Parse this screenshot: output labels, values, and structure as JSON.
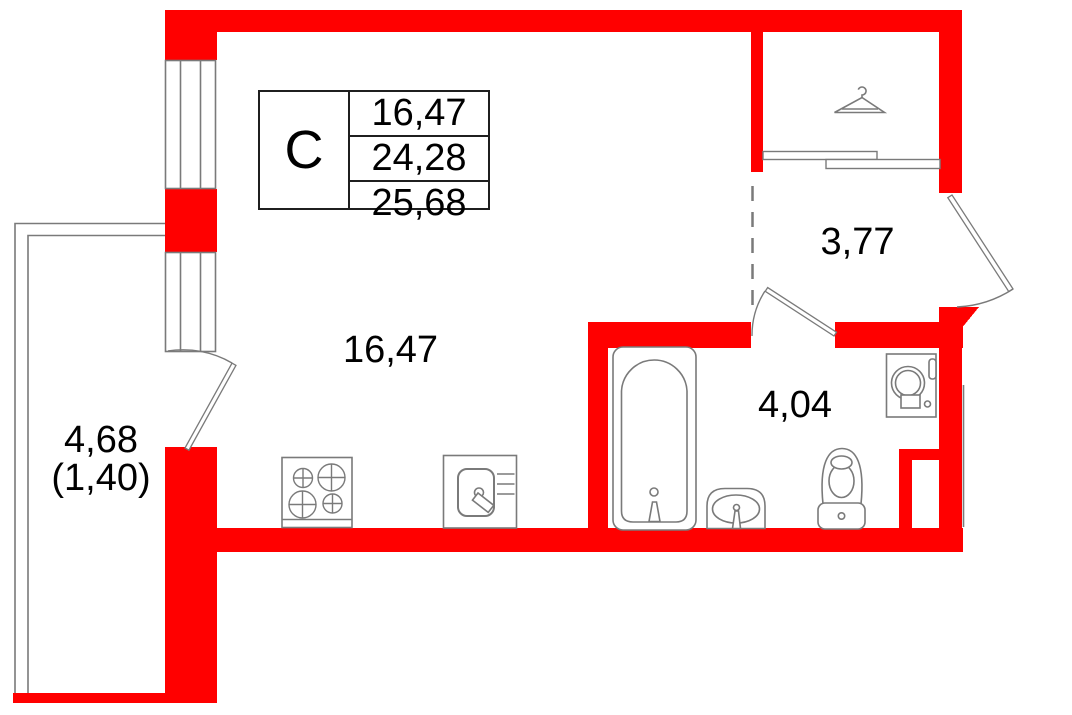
{
  "floorplan": {
    "title_block": {
      "unit_type_label": "C",
      "rows": [
        "16,47",
        "24,28",
        "25,68"
      ]
    },
    "rooms": [
      {
        "id": "living-room",
        "area_label": "16,47"
      },
      {
        "id": "hallway",
        "area_label": "3,77"
      },
      {
        "id": "bathroom",
        "area_label": "4,04"
      },
      {
        "id": "balcony",
        "area_label": "4,68",
        "area_secondary_label": "(1,40)"
      }
    ],
    "fixtures": [
      "hanger-icon",
      "bathtub-icon",
      "washbasin-icon",
      "toilet-icon",
      "washing-machine-icon",
      "stove-icon",
      "kitchen-sink-icon"
    ],
    "colors": {
      "wall_red": "#ff0000",
      "linework_gray": "#7a7a7a",
      "text_black": "#000000"
    }
  }
}
